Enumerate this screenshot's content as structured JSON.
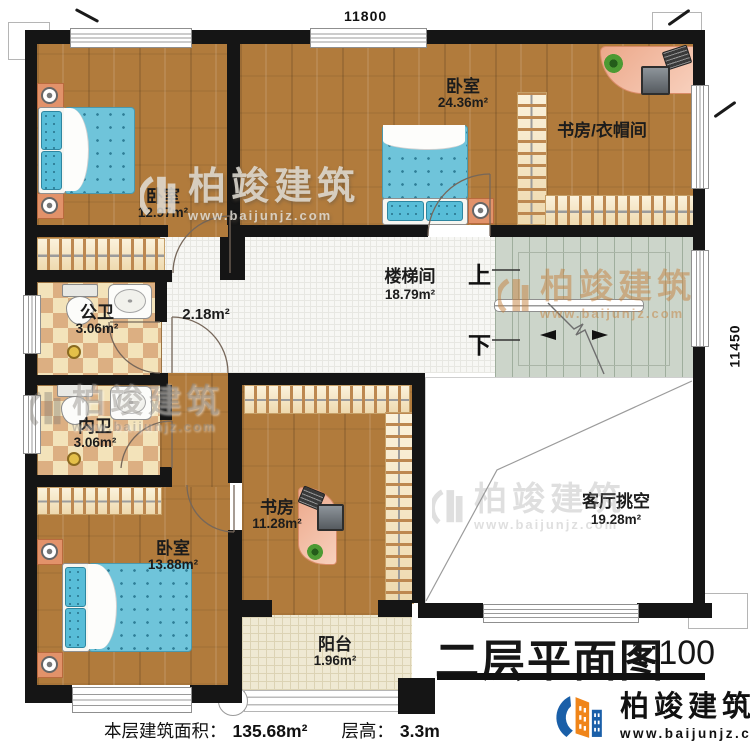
{
  "title": {
    "text": "二层平面图",
    "scale": "1:100"
  },
  "footer": {
    "area_label": "本层建筑面积：",
    "area_value": "135.68m²",
    "floor_height_label": "层高：",
    "floor_height_value": "3.3m"
  },
  "dimensions": {
    "top": "11800",
    "right": "11450"
  },
  "stairs": {
    "up": "上",
    "down": "下"
  },
  "rooms": [
    {
      "name": "卧室",
      "area": "12.97m²"
    },
    {
      "name": "卧室",
      "area": "24.36m²"
    },
    {
      "name": "书房/衣帽间",
      "area": ""
    },
    {
      "name": "楼梯间",
      "area": "18.79m²"
    },
    {
      "name": "",
      "area": "2.18m²"
    },
    {
      "name": "公卫",
      "area": "3.06m²"
    },
    {
      "name": "内卫",
      "area": "3.06m²"
    },
    {
      "name": "卧室",
      "area": "13.88m²"
    },
    {
      "name": "书房",
      "area": "11.28m²"
    },
    {
      "name": "客厅挑空",
      "area": "19.28m²"
    },
    {
      "name": "阳台",
      "area": "1.96m²"
    }
  ],
  "brand": {
    "name": "柏竣建筑",
    "url": "www.baijunjz.com"
  },
  "colors": {
    "wall": "#151515",
    "wood_floor": "#b17b3c",
    "mattress_blue": "#6fc4da",
    "stair_green": "#ccd5ca",
    "brand_blue": "#1a5fa8",
    "brand_orange": "#f08519"
  }
}
